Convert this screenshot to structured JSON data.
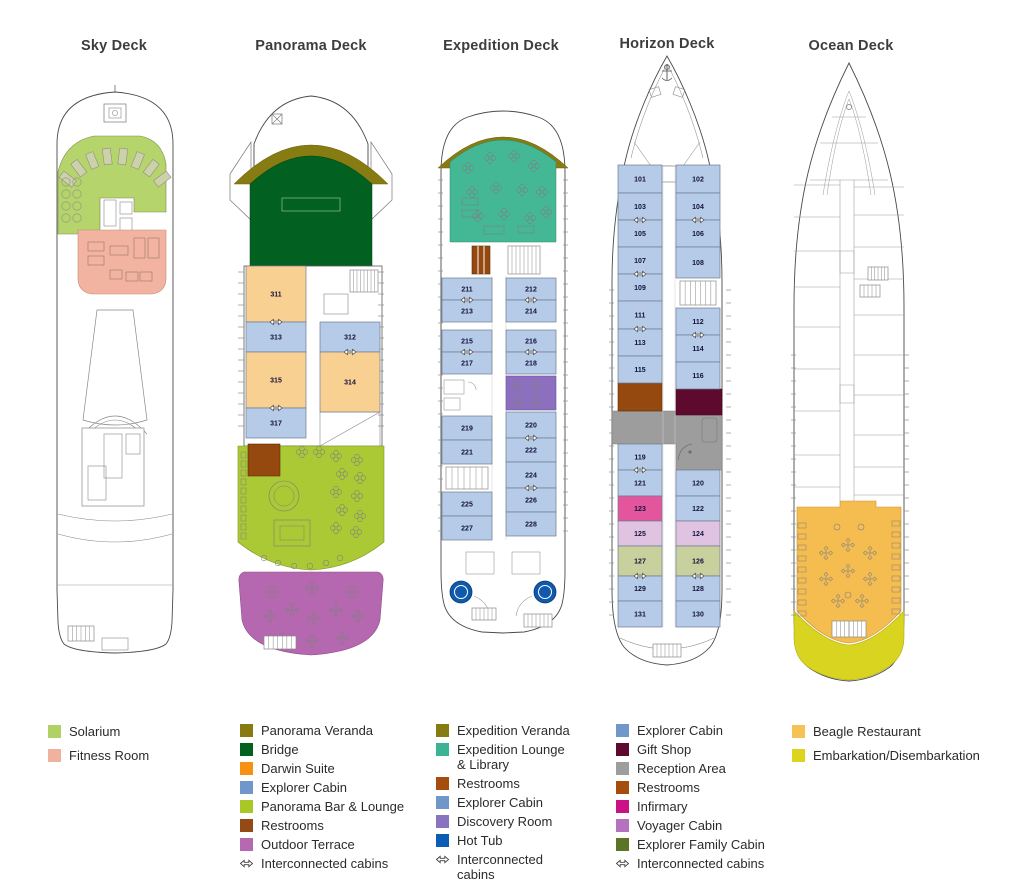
{
  "colors": {
    "solarium": "#b5d46b",
    "fitness": "#f2b4a1",
    "veranda": "#867c12",
    "bridge": "#026020",
    "darwin": "#f8d092",
    "explorer": "#b6cbe7",
    "bar_lounge": "#abc935",
    "restroom": "#95490f",
    "terrace": "#b568b0",
    "exp_lounge": "#44b795",
    "discovery": "#8d6fc0",
    "hot_tub": "#0f5aac",
    "gift": "#5e0a2e",
    "reception": "#9d9d9d",
    "infirmary": "#e3569e",
    "voyager": "#e0c3e1",
    "family": "#c8d09d",
    "beagle": "#f5bd50",
    "embark": "#d9d41f"
  },
  "decks": [
    {
      "id": "sky",
      "title": "Sky Deck",
      "legend": [
        {
          "label": "Solarium",
          "color": "#b2d164"
        },
        {
          "label": "Fitness Room",
          "color": "#f0b19e"
        }
      ]
    },
    {
      "id": "panorama",
      "title": "Panorama Deck",
      "cabins": {
        "left": [
          {
            "number": "311",
            "type": "darwin"
          },
          {
            "number": "313"
          },
          {
            "number": "315",
            "type": "darwin"
          },
          {
            "number": "317"
          }
        ],
        "right": [
          {
            "number": "312"
          },
          {
            "number": "314",
            "type": "darwin"
          }
        ]
      },
      "legend": [
        {
          "label": "Panorama Veranda",
          "color": "#867c12"
        },
        {
          "label": "Bridge",
          "color": "#026020"
        },
        {
          "label": "Darwin Suite",
          "color": "#f69114"
        },
        {
          "label": "Explorer Cabin",
          "color": "#6f97ca"
        },
        {
          "label": "Panorama Bar & Lounge",
          "color": "#a9c827"
        },
        {
          "label": "Restrooms",
          "color": "#944a15"
        },
        {
          "label": "Outdoor Terrace",
          "color": "#b569b1"
        },
        {
          "label": "Interconnected cabins",
          "icon": "interconnect-arrows-icon"
        }
      ]
    },
    {
      "id": "expedition",
      "title": "Expedition Deck",
      "cabins": {
        "left": [
          {
            "number": "211"
          },
          {
            "number": "213"
          },
          {
            "number": "215"
          },
          {
            "number": "217"
          },
          {
            "number": "219"
          },
          {
            "number": "221"
          },
          {
            "number": "225"
          },
          {
            "number": "227"
          }
        ],
        "right": [
          {
            "number": "212"
          },
          {
            "number": "214"
          },
          {
            "number": "216"
          },
          {
            "number": "218"
          },
          {
            "number": "220"
          },
          {
            "number": "222"
          },
          {
            "number": "224"
          },
          {
            "number": "226"
          },
          {
            "number": "228"
          }
        ]
      },
      "legend": [
        {
          "label": "Expedition Veranda",
          "color": "#867c12"
        },
        {
          "label": "Expedition Lounge & Library",
          "color": "#3cb493"
        },
        {
          "label": "Restrooms",
          "color": "#a54d0d"
        },
        {
          "label": "Explorer Cabin",
          "color": "#6f97ca"
        },
        {
          "label": "Discovery Room",
          "color": "#8a74c0"
        },
        {
          "label": "Hot Tub",
          "color": "#0b5cb4"
        },
        {
          "label": "Interconnected cabins",
          "icon": "interconnect-arrows-icon"
        }
      ]
    },
    {
      "id": "horizon",
      "title": "Horizon Deck",
      "cabins": {
        "left": [
          {
            "number": "101"
          },
          {
            "number": "103"
          },
          {
            "number": "105"
          },
          {
            "number": "107"
          },
          {
            "number": "109"
          },
          {
            "number": "111"
          },
          {
            "number": "113"
          },
          {
            "number": "115"
          },
          {
            "number": "119"
          },
          {
            "number": "121"
          },
          {
            "number": "123",
            "type": "infirmary"
          },
          {
            "number": "125",
            "type": "voyager"
          },
          {
            "number": "127",
            "type": "family"
          },
          {
            "number": "129"
          },
          {
            "number": "131"
          }
        ],
        "right": [
          {
            "number": "102"
          },
          {
            "number": "104"
          },
          {
            "number": "106"
          },
          {
            "number": "108"
          },
          {
            "number": "112"
          },
          {
            "number": "114"
          },
          {
            "number": "116"
          },
          {
            "number": "120"
          },
          {
            "number": "122"
          },
          {
            "number": "124",
            "type": "voyager"
          },
          {
            "number": "126",
            "type": "family"
          },
          {
            "number": "128"
          },
          {
            "number": "130"
          }
        ]
      },
      "legend": [
        {
          "label": "Explorer Cabin",
          "color": "#6f97ca"
        },
        {
          "label": "Gift Shop",
          "color": "#5e0a2e"
        },
        {
          "label": "Reception Area",
          "color": "#9d9d9d"
        },
        {
          "label": "Restrooms",
          "color": "#a54d0d"
        },
        {
          "label": "Infirmary",
          "color": "#cc1085"
        },
        {
          "label": "Voyager Cabin",
          "color": "#b671c0"
        },
        {
          "label": "Explorer Family Cabin",
          "color": "#5b7425"
        },
        {
          "label": "Interconnected cabins",
          "icon": "interconnect-arrows-icon"
        }
      ]
    },
    {
      "id": "ocean",
      "title": "Ocean Deck",
      "legend": [
        {
          "label": "Beagle Restaurant",
          "color": "#f6c255"
        },
        {
          "label": "Embarkation/Disembarkation",
          "color": "#ddd41d"
        }
      ]
    }
  ]
}
